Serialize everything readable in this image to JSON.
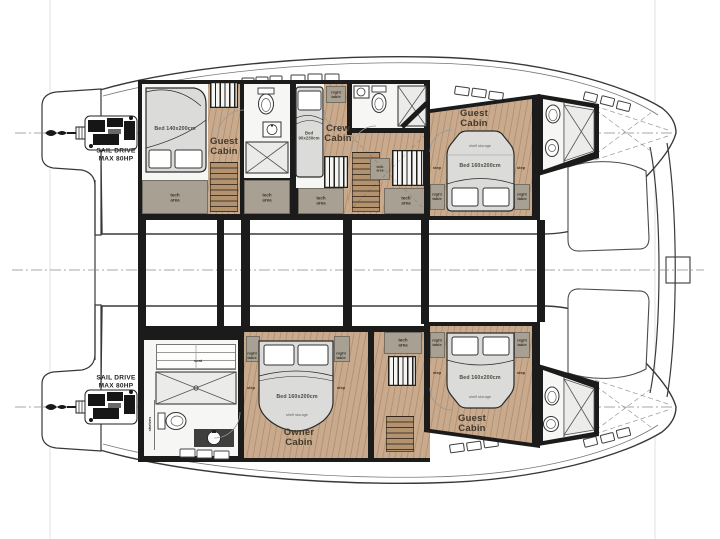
{
  "labels": {
    "engine_line1": "SAIL DRIVE",
    "engine_line2": "MAX 80HP",
    "guest": "Guest",
    "crew": "Crew",
    "owner": "Owner",
    "cabin": "Cabin",
    "bed_aft_guest": "Bed 140x200cm",
    "bed_crew_line1": "Bed",
    "bed_crew_line2": "90x230cm",
    "bed_double": "Bed 160x200cm",
    "shelf_storage": "shelf storage",
    "tech_line1": "tech",
    "tech_line2": "area",
    "night_line1": "night",
    "night_line2": "table",
    "step": "step",
    "seat": "seat",
    "shelves": "shelves"
  },
  "colors": {
    "wall": "#1b1b1b",
    "wood_floor": "#c9aa8c",
    "stairs_wood": "#b2926f",
    "tech_gray": "#a8a193",
    "bed_fill": "#dbdbd9",
    "bathroom_floor": "#f6f6f4",
    "hull_outline": "#383838",
    "centerline": "#8a8a8a",
    "guide_line": "#e2e2e2"
  }
}
